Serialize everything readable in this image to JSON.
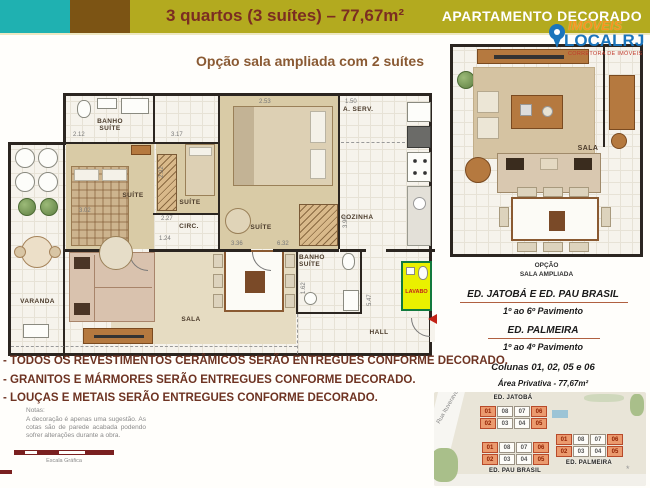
{
  "colors": {
    "header_teal": "#1FB1B1",
    "header_brown": "#7C5414",
    "header_olive": "#B3AA1F",
    "title_text": "#7B2D22",
    "subtitle_text": "#8A5A33",
    "disclaimer_text": "#6E3322",
    "logo_orange": "#F7941D",
    "logo_blue": "#1B75BC",
    "lavabo_yellow": "#EAF000",
    "lavabo_border": "#127A3E",
    "unit_highlight": "#EB9A6E",
    "wall": "#2B2520"
  },
  "header": {
    "title": "3 quartos (3 suítes) – 77,67m²",
    "badge": "APARTAMENTO DECORADO"
  },
  "logo": {
    "brand_top": "IMÓVEIS",
    "brand_bottom": "LOCALRJ",
    "tagline": "CORRETORA DE IMÓVEIS"
  },
  "subtitle": "Opção sala ampliada com 2 suítes",
  "plan": {
    "rooms": {
      "varanda": "VARANDA",
      "banho_suite_top_l1": "BANHO",
      "banho_suite_top_l2": "SUÍTE",
      "suite_left": "SUÍTE",
      "suite_mid": "SUÍTE",
      "suite_top": "SUÍTE",
      "aserv": "A. SERV.",
      "cozinha": "COZINHA",
      "circ": "CIRC.",
      "sala": "SALA",
      "banho_mid_l1": "BANHO",
      "banho_mid_l2": "SUÍTE",
      "lavabo": "LAVABO",
      "hall": "HALL"
    },
    "dims": {
      "d1": "2.12",
      "d2": "3.17",
      "d3": "2.53",
      "d4": "1.50",
      "d5": "2.92",
      "d6": "2.27",
      "d7": "1.24",
      "d8": "3.02",
      "d9": "3.36",
      "d10": "6.32",
      "d11": "3.90",
      "d12": "1.62",
      "d13": "5.47"
    }
  },
  "option_plan": {
    "room": "SALA",
    "caption_l1": "OPÇÃO",
    "caption_l2": "SALA AMPLIADA"
  },
  "info": {
    "buildings1": "ED. JATOBÁ  E  ED. PAU BRASIL",
    "floors1": "1º ao 6º Pavimento",
    "building2": "ED. PALMEIRA",
    "floors2": "1º ao 4º Pavimento",
    "columns": "Colunas 01, 02, 05 e 06",
    "area": "Área Privativa - 77,67m²"
  },
  "disclaimers": {
    "line1": "- TODOS OS REVESTIMENTOS CERÂMICOS SERÃO ENTREGUES CONFORME DECORADO.",
    "line2": "- GRANITOS E MÁRMORES SERÃO ENTREGUES CONFORME DECORADO.",
    "line3": "- LOUÇAS E METAIS SERÃO ENTREGUES CONFORME DECORADO."
  },
  "notes": {
    "title": "Notas:",
    "body": "A decoração é apenas uma sugestão. As cotas são de parede acabada podendo sofrer alterações durante a obra.",
    "scale_label": "Escala Gráfica"
  },
  "site_map": {
    "street": "Rua Ituverava, 562",
    "jatoba": {
      "name": "ED. JATOBÁ",
      "units": [
        "01",
        "08",
        "07",
        "06",
        "02",
        "03",
        "04",
        "05"
      ]
    },
    "pau_brasil": {
      "name": "ED. PAU BRASIL",
      "units": [
        "01",
        "08",
        "07",
        "06",
        "02",
        "03",
        "04",
        "05"
      ]
    },
    "palmeira": {
      "name": "ED. PALMEIRA",
      "units": [
        "01",
        "08",
        "07",
        "06",
        "02",
        "03",
        "04",
        "05"
      ]
    },
    "highlighted": "01, 02, 05, 06"
  }
}
